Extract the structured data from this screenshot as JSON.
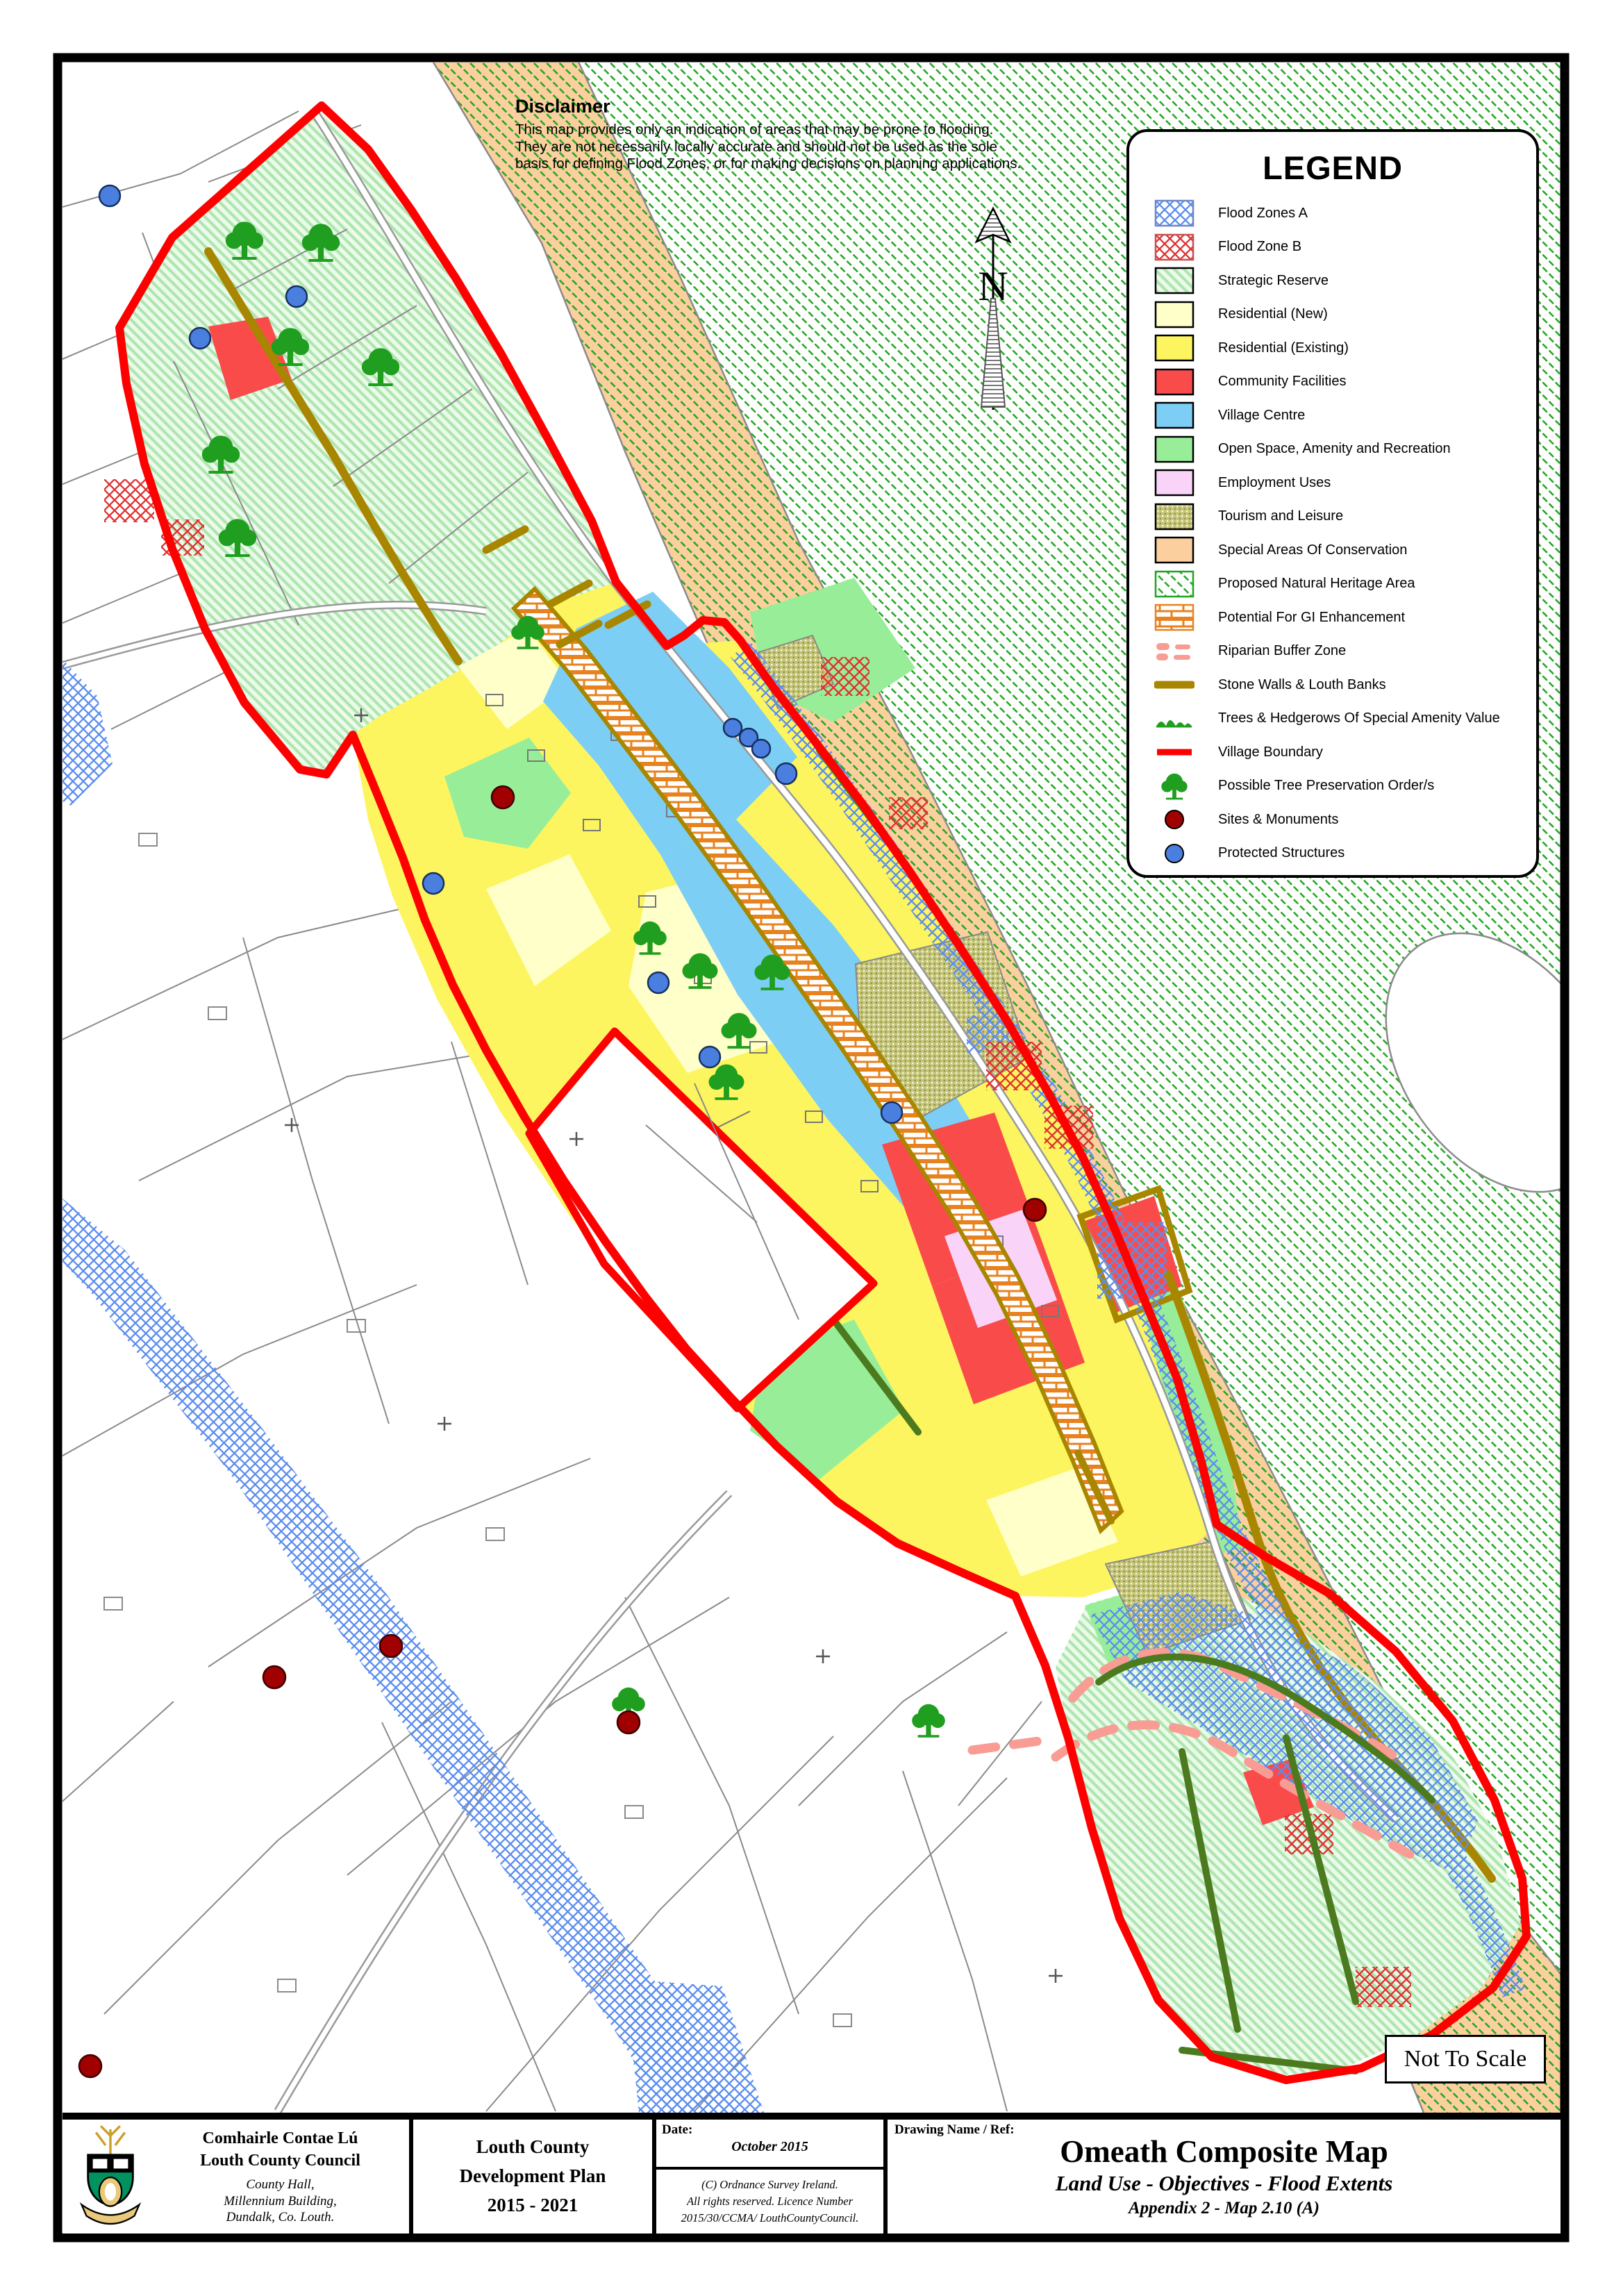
{
  "page": {
    "scale_note": "Not To Scale",
    "north_label": "N"
  },
  "disclaimer": {
    "heading": "Disclaimer",
    "lines": [
      "This map provides only an indication of areas that may be prone to flooding.",
      "They are not necessarily locally accurate and should not be used as the sole",
      "basis for defining Flood Zones, or for making decisions on planning applications."
    ]
  },
  "legend": {
    "title": "LEGEND",
    "items": [
      {
        "label": "Flood Zones A",
        "swatch": "flood-a"
      },
      {
        "label": "Flood Zone B",
        "swatch": "flood-b"
      },
      {
        "label": "Strategic Reserve",
        "swatch": "strategic"
      },
      {
        "label": "Residential (New)",
        "swatch": "res-new"
      },
      {
        "label": "Residential (Existing)",
        "swatch": "res-existing"
      },
      {
        "label": "Community Facilities",
        "swatch": "community"
      },
      {
        "label": "Village Centre",
        "swatch": "village-centre"
      },
      {
        "label": "Open Space, Amenity and Recreation",
        "swatch": "open-space"
      },
      {
        "label": "Employment Uses",
        "swatch": "employment"
      },
      {
        "label": "Tourism and Leisure",
        "swatch": "tourism"
      },
      {
        "label": "Special Areas Of Conservation",
        "swatch": "sac"
      },
      {
        "label": "Proposed Natural Heritage Area",
        "swatch": "pnha"
      },
      {
        "label": "Potential For GI Enhancement",
        "swatch": "gi"
      },
      {
        "label": "Riparian Buffer Zone",
        "swatch": "riparian"
      },
      {
        "label": "Stone Walls & Louth Banks",
        "swatch": "stone-wall"
      },
      {
        "label": "Trees & Hedgerows Of Special Amenity Value",
        "swatch": "trees-hedgerows"
      },
      {
        "label": "Village Boundary",
        "swatch": "village-boundary"
      },
      {
        "label": "Possible Tree Preservation Order/s",
        "swatch": "tpo-tree"
      },
      {
        "label": "Sites & Monuments",
        "swatch": "monument"
      },
      {
        "label": "Protected Structures",
        "swatch": "protected"
      }
    ]
  },
  "title_block": {
    "council": {
      "name_irish": "Comhairle Contae Lú",
      "name_english": "Louth County Council",
      "address_lines": [
        "County Hall,",
        "Millennium Building,",
        "Dundalk, Co. Louth."
      ]
    },
    "plan": {
      "lines": [
        "Louth County",
        "Development Plan",
        "2015 - 2021"
      ]
    },
    "date": {
      "label": "Date:",
      "value": "October 2015"
    },
    "copyright_lines": [
      "(C) Ordnance Survey Ireland.",
      "All rights reserved. Licence Number",
      "2015/30/CCMA/ LouthCountyCouncil."
    ],
    "drawing": {
      "label": "Drawing Name / Ref:",
      "title": "Omeath Composite Map",
      "subtitle": "Land Use - Objectives - Flood Extents",
      "appendix": "Appendix 2 - Map 2.10 (A)"
    }
  },
  "colors": {
    "village_boundary": "#FF0000",
    "flood_zone_a": "#5B8DEE",
    "flood_zone_b": "#E03030",
    "strategic_reserve_stripe": "#AEE6AE",
    "residential_new": "#FFFFC9",
    "residential_existing": "#FCF55F",
    "community_facilities": "#FA4B4B",
    "village_centre": "#7CCEF4",
    "open_space": "#98EE98",
    "employment_uses": "#FAD4F8",
    "tourism_leisure": "#C6C67A",
    "special_areas_conservation": "#FBCF9E",
    "proposed_natural_heritage": "#1FA51F",
    "gi_enhancement": "#E8821E",
    "riparian_buffer": "#F89C94",
    "stone_walls": "#A98600",
    "hedgerow": "#4C7A1E",
    "sites_monuments": "#A00000",
    "protected_structures": "#4A7FE0"
  }
}
